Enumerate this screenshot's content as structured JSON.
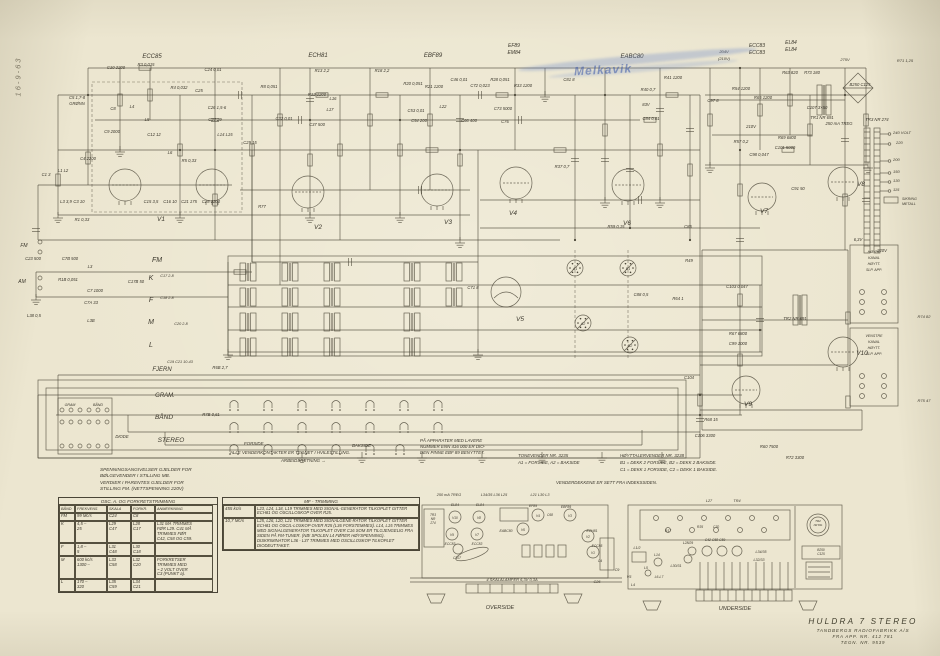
{
  "page": {
    "bg": "#ece6d0",
    "ink": "#4a4537",
    "stamp_blue": "#3a58a8"
  },
  "date_note": "16-9-63",
  "stamp": {
    "text": "Melkavik"
  },
  "title_block": {
    "model": "HULDRA 7 STEREO",
    "maker": "TANDBERGS RADIOFABRIKK A/S",
    "serial": "FRA APP. NR. 412 781",
    "drawing": "TEGN. NR. 9539"
  },
  "notes": {
    "voltage": "SPENNINGSANGIVELSER GJELDER FOR\nBØLGEVENDER I STILLING MB.\nVERDIER I PARENTES GJELDER FOR\nSTILLING FM. (NETTSPENNING 220V)",
    "forside": "FORSIDE",
    "bakside": "BAKSIDE",
    "contacts": "ALLE VENDERKONTAKTER ER TEGNET I HVILESTILLING.",
    "direction": "ARBEIDSRETNING  →",
    "lower_numbers": "PÅ APPARATER MED LAVERE\nNUMMER ENN 416 000 ER DIO-\nDEN PINNE EBF 89 BENYTTET.",
    "tonevender": "TONEVENDER NR. 3235\nA1 = FORSIDE, A2 = BAKSIDE",
    "hoyttalervender": "HØYTTALERVENDER NR. 3238\nB1 = DEKK 2 FORSIDE, B2 = DEKK 2 BAKSIDE.\nC1 = DEKK 1 FORSIDE, C2 = DEKK 1 BAKSIDE.",
    "venderdekkene": "VENDERDEKKENE ER SETT FRA INDEKSSIDEN."
  },
  "table": {
    "title": "OSC. A. OG FORKRETSTRIMMING",
    "columns": [
      "BÅND",
      "FREKVENS",
      "SKALA",
      "FORKR.",
      "ANMERKNING"
    ],
    "rows": [
      [
        "FM",
        "99 Mc/s",
        "C24",
        "C8",
        ""
      ],
      [
        "K",
        "4,5 –\n25",
        "L29\nC47",
        "L28\nC17",
        "L31 MÅ TRIMMES\nFØR L29. C41 MÅ\nTRIMMES FØR\nC42, C58 OG C59."
      ],
      [
        "F",
        "1,8 –\n5",
        "L31\nC48",
        "L30\nC18",
        ""
      ],
      [
        "M",
        "600 kc/s\n1300 –",
        "L33\nC58",
        "L32\nC20",
        "FORKRETSER\nTRIMMES MED\n~ 2 VOLT OVER\nC3 (PUNKT a)."
      ],
      [
        "L",
        "170 –\n320",
        "L35\nC59",
        "L34\nC21",
        ""
      ]
    ]
  },
  "mf": {
    "title": "MF - TRIMMING",
    "sections": [
      {
        "freq": "455 kc/s",
        "text": "L23, L24, L18, L19 TRIMMES MED SIGNAL-GENERATOR TILKOPLET GITTER ECH81 OG OSCILLOSKOP OVER R25."
      },
      {
        "freq": "10,7 Mc/s",
        "text": "L25, L26, L20, L21 TRIMMES MED SIGNALGENE-RATOR TILKOPLET GITTER ECH81 OG OSCIL-LOSKOP OVER R25 (L36 FORSTEMMES). L14, L15 TRIMMES MED SIGNALGENERATOR TILKOPLET OVER C16 SOM ER TILGJENGELIG FRA SIDEN PÅ FM-TUNER. (NB! SPOLEN L4 FØRER HØYSPENNING). DISKRIMINATOR L36 - L37 TRIMMES MED OSCILLOSKOP TILKOPLET DIODEUTTAKET."
      }
    ]
  },
  "labels": [
    [
      "ECC85",
      152,
      58,
      6
    ],
    [
      "ECH81",
      318,
      57,
      6
    ],
    [
      "EBF89",
      433,
      57,
      6
    ],
    [
      "EF89",
      514,
      47,
      5
    ],
    [
      "EM84",
      514,
      54,
      5
    ],
    [
      "EABC80",
      632,
      58,
      6
    ],
    [
      "ECC83",
      757,
      47,
      5
    ],
    [
      "ECC83",
      757,
      54,
      5
    ],
    [
      "EL84",
      791,
      44,
      5
    ],
    [
      "EL84",
      791,
      51,
      5
    ],
    [
      "204V",
      724,
      53,
      4
    ],
    [
      "(210V)",
      724,
      60,
      4
    ],
    [
      "275V",
      845,
      61,
      4
    ],
    [
      "R71 1,25",
      905,
      62,
      4
    ],
    [
      "V1",
      161,
      221,
      6.5
    ],
    [
      "V2",
      318,
      229,
      6.5
    ],
    [
      "V3",
      448,
      224,
      6.5
    ],
    [
      "V4",
      513,
      215,
      6.5
    ],
    [
      "V5",
      520,
      321,
      6.5
    ],
    [
      "V6",
      627,
      225,
      6.5
    ],
    [
      "V7",
      764,
      213,
      6.5
    ],
    [
      "V8",
      861,
      186,
      6.5
    ],
    [
      "V9",
      748,
      406,
      6.5
    ],
    [
      "V10",
      862,
      355,
      6.5
    ],
    [
      "C10 2200",
      116,
      69
    ],
    [
      "R3 0,015",
      146,
      66
    ],
    [
      "C24 0,01",
      213,
      71
    ],
    [
      "R4 0,032",
      179,
      89
    ],
    [
      "C25",
      199,
      92
    ],
    [
      "C26 1,5-6",
      217,
      109
    ],
    [
      "C27 29",
      215,
      121
    ],
    [
      "C5 1,7-8",
      77,
      99
    ],
    [
      "GRØNN",
      77,
      105
    ],
    [
      "C8",
      113,
      110
    ],
    [
      "L4",
      132,
      108
    ],
    [
      "L5",
      147,
      121
    ],
    [
      "C12 12",
      154,
      136
    ],
    [
      "C9 2000",
      112,
      133
    ],
    [
      "L6",
      170,
      154
    ],
    [
      "C4 2200",
      88,
      160
    ],
    [
      "R5 0,33",
      189,
      162
    ],
    [
      "L14 L15",
      225,
      136
    ],
    [
      "C29 15",
      250,
      144
    ],
    [
      "L1 L2",
      63,
      172
    ],
    [
      "C1 3",
      46,
      176
    ],
    [
      "L3 3,9",
      66,
      203
    ],
    [
      "C3 10",
      79,
      203
    ],
    [
      "C15 3,5",
      151,
      203
    ],
    [
      "C16 10",
      170,
      203
    ],
    [
      "C21 175",
      189,
      203
    ],
    [
      "C28 2200",
      211,
      203
    ],
    [
      "R1 0,33",
      82,
      221
    ],
    [
      "C23 500",
      33,
      260
    ],
    [
      "L38 0,5",
      34,
      317
    ],
    [
      "FM",
      24,
      247,
      5
    ],
    [
      "AM",
      22,
      283,
      5
    ],
    [
      "R13 2,2",
      322,
      72
    ],
    [
      "R18 2,2",
      382,
      72
    ],
    [
      "R8 0,051",
      269,
      88
    ],
    [
      "R12 1200",
      317,
      96
    ],
    [
      "L16",
      333,
      100
    ],
    [
      "L17",
      330,
      111
    ],
    [
      "C32 0,01",
      284,
      120
    ],
    [
      "C37 500",
      317,
      126
    ],
    [
      "R20 0,051",
      413,
      85
    ],
    [
      "R21 1200",
      434,
      88
    ],
    [
      "C46 0,01",
      459,
      81
    ],
    [
      "C72 0,023",
      480,
      87
    ],
    [
      "C53 0,01",
      416,
      112
    ],
    [
      "C54 200",
      419,
      122
    ],
    [
      "L22",
      443,
      108
    ],
    [
      "C66 400",
      469,
      122
    ],
    [
      "R28 0,051",
      500,
      81
    ],
    [
      "R33 1200",
      523,
      87
    ],
    [
      "C73 5000",
      503,
      110
    ],
    [
      "C76",
      505,
      123
    ],
    [
      "C81 8",
      569,
      81
    ],
    [
      "R77",
      262,
      208
    ],
    [
      "R37 0,7",
      562,
      168
    ],
    [
      "C85",
      688,
      228
    ],
    [
      "R59 0,15",
      616,
      228
    ],
    [
      "R41 1200",
      673,
      79
    ],
    [
      "R40 0,7",
      648,
      91
    ],
    [
      "83V",
      646,
      106
    ],
    [
      "C84 0,01",
      651,
      120
    ],
    [
      "R54 1200",
      741,
      90
    ],
    [
      "R65 1200",
      763,
      99
    ],
    [
      "C97 8",
      713,
      102
    ],
    [
      "R63 820",
      790,
      74
    ],
    [
      "R73 180",
      812,
      74
    ],
    [
      "C107 3×50",
      817,
      109
    ],
    [
      "TR1 NR 691",
      822,
      119
    ],
    [
      "250 mA TREG",
      839,
      125
    ],
    [
      "B250 C125",
      860,
      86
    ],
    [
      "TR3 NR 274",
      877,
      121
    ],
    [
      "240 VOLT",
      893,
      134,
      4,
      "s"
    ],
    [
      "220",
      896,
      144,
      4,
      "s"
    ],
    [
      "200",
      893,
      161,
      4,
      "s"
    ],
    [
      "150",
      893,
      173,
      4,
      "s"
    ],
    [
      "130",
      893,
      182,
      4,
      "s"
    ],
    [
      "115",
      893,
      191,
      4,
      "s"
    ],
    [
      "SIKRING",
      902,
      200,
      3.6,
      "s"
    ],
    [
      "METALL",
      902,
      205,
      3.6,
      "s"
    ],
    [
      "6,3V",
      858,
      241
    ],
    [
      "220V",
      882,
      252
    ],
    [
      "210V",
      751,
      128
    ],
    [
      "R57 0,2",
      741,
      143
    ],
    [
      "R69 6800",
      787,
      139
    ],
    [
      "C101 5000",
      785,
      149
    ],
    [
      "C98 0,047",
      759,
      156
    ],
    [
      "C91 50",
      798,
      190
    ],
    [
      "C71 8",
      473,
      289
    ],
    [
      "C103 0,047",
      737,
      288
    ],
    [
      "R49",
      689,
      262
    ],
    [
      "C88 0,5",
      641,
      296
    ],
    [
      "R64 1",
      678,
      300
    ],
    [
      "R67 6800",
      738,
      335
    ],
    [
      "C99 1000",
      738,
      345
    ],
    [
      "C104",
      689,
      379
    ],
    [
      "R68 15",
      711,
      421
    ],
    [
      "C106 3300",
      705,
      437
    ],
    [
      "TR2 NR 691",
      795,
      320
    ],
    [
      "R60 7500",
      769,
      448
    ],
    [
      "R72 3300",
      795,
      459
    ],
    [
      "R74 82",
      924,
      318,
      4
    ],
    [
      "R75 47",
      924,
      402,
      4
    ],
    [
      "A1",
      575,
      270,
      3.6
    ],
    [
      "B1",
      628,
      270,
      3.6
    ],
    [
      "A2",
      583,
      325,
      3.6
    ],
    [
      "B2",
      630,
      347,
      3.6
    ],
    [
      "C7B 500",
      70,
      260
    ],
    [
      "L3",
      90,
      268
    ],
    [
      "R1B 0,051",
      68,
      281
    ],
    [
      "C17B 50",
      136,
      283
    ],
    [
      "C7 1000",
      95,
      292
    ],
    [
      "C7A 33",
      91,
      304
    ],
    [
      "L3B",
      91,
      322
    ],
    [
      "FM",
      157,
      262,
      7
    ],
    [
      "K",
      151,
      280,
      7
    ],
    [
      "C17 2-8",
      167,
      277,
      3.8
    ],
    [
      "F",
      151,
      302,
      7
    ],
    [
      "C18 2-8",
      167,
      299,
      3.8
    ],
    [
      "M",
      151,
      324,
      7
    ],
    [
      "C20 2-8",
      181,
      325,
      3.8
    ],
    [
      "L",
      151,
      347,
      7
    ],
    [
      "FJERN",
      162,
      371,
      6
    ],
    [
      "C19 C21 10-43",
      180,
      363,
      3.8
    ],
    [
      "R6B 2,7",
      220,
      369
    ],
    [
      "GRAM.",
      165,
      397,
      6
    ],
    [
      "BÅND",
      164,
      419,
      6.5
    ],
    [
      "STEREO",
      171,
      442,
      6.5
    ],
    [
      "DIODE",
      122,
      438,
      4.2
    ],
    [
      "GRAM",
      70,
      406,
      3.6
    ],
    [
      "BÅND",
      98,
      406,
      3.6
    ],
    [
      "R7B 0,61",
      211,
      416
    ],
    [
      "250 mA TREG",
      449,
      496,
      3.8
    ],
    [
      "L34/35 L36 L25",
      494,
      496,
      3.8
    ],
    [
      "L21 L30 L3",
      540,
      496,
      3.8
    ],
    [
      "EL84",
      455,
      506,
      3.4
    ],
    [
      "EL84",
      480,
      506,
      3.4
    ],
    [
      "V10",
      455,
      519,
      3.2
    ],
    [
      "V8",
      479,
      519,
      3.2
    ],
    [
      "ECC83",
      450,
      545,
      3.3
    ],
    [
      "ECC83",
      477,
      545,
      3.3
    ],
    [
      "V9",
      452,
      536,
      3.2
    ],
    [
      "V7",
      477,
      536,
      3.2
    ],
    [
      "C107",
      457,
      559,
      3.4
    ],
    [
      "EABC80",
      506,
      532,
      3.4
    ],
    [
      "V6",
      523,
      531,
      3.2
    ],
    [
      "EF89",
      533,
      507,
      3.4
    ],
    [
      "V4",
      538,
      517,
      3.2
    ],
    [
      "C68",
      550,
      516,
      3.3
    ],
    [
      "EBF89",
      566,
      508,
      3.4
    ],
    [
      "V3",
      570,
      517,
      3.2
    ],
    [
      "ECH81",
      592,
      532,
      3.4
    ],
    [
      "V2",
      588,
      538,
      3.2
    ],
    [
      "ECC85",
      597,
      547,
      3.3
    ],
    [
      "V1",
      593,
      554,
      3.2
    ],
    [
      "C4",
      600,
      562,
      3.3
    ],
    [
      "TR3",
      433,
      516,
      3.2
    ],
    [
      "NR",
      433,
      520,
      3.2
    ],
    [
      "274",
      433,
      524,
      3.2
    ],
    [
      "4 SKALALAMPER 6,3V 0,3A",
      512,
      581,
      4
    ],
    [
      "OVERSIDE",
      500,
      609,
      5.5
    ],
    [
      "C9",
      617,
      571,
      3.8
    ],
    [
      "V5",
      629,
      578,
      3.8
    ],
    [
      "C26",
      597,
      583,
      3.8
    ],
    [
      "L27",
      709,
      502,
      3.8
    ],
    [
      "TR4",
      737,
      502,
      3.8
    ],
    [
      "R17",
      668,
      532,
      3.4
    ],
    [
      "R35",
      700,
      528,
      3.4
    ],
    [
      "C70",
      716,
      528,
      3.4
    ],
    [
      "L28/29",
      688,
      544,
      3.4
    ],
    [
      "C42 C58 C59",
      715,
      541,
      3.4
    ],
    [
      "L34/35",
      761,
      553,
      3.6
    ],
    [
      "L32/33",
      759,
      561,
      3.6
    ],
    [
      "L30/31",
      676,
      567,
      3.6
    ],
    [
      "L1/2",
      637,
      549,
      3.6
    ],
    [
      "L14",
      657,
      556,
      3.4
    ],
    [
      "L5",
      646,
      569,
      3.4
    ],
    [
      "L6-L7",
      659,
      578,
      3.4
    ],
    [
      "L4",
      633,
      586,
      3.6
    ],
    [
      "TR2",
      818,
      522,
      3
    ],
    [
      "NR 691",
      818,
      526,
      2.6
    ],
    [
      "B250",
      821,
      551,
      3.2
    ],
    [
      "C125",
      821,
      555,
      3.2
    ],
    [
      "UNDERSIDE",
      735,
      610,
      5.5
    ],
    [
      "HØYRE",
      874,
      253,
      3.6
    ],
    [
      "KANAL",
      874,
      259,
      3.6
    ],
    [
      "HØYTT.",
      874,
      265,
      3.6
    ],
    [
      "SLP. APP.",
      874,
      271,
      3.6
    ],
    [
      "VENSTRE",
      874,
      337,
      3.6
    ],
    [
      "KANAL",
      874,
      343,
      3.6
    ],
    [
      "HØYTT.",
      874,
      349,
      3.6
    ],
    [
      "SLP. APP.",
      874,
      355,
      3.6
    ]
  ]
}
